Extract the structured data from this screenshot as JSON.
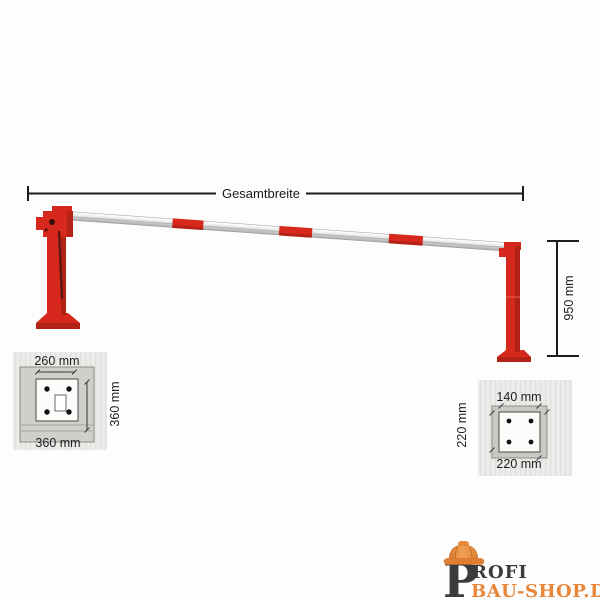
{
  "dimensions": {
    "total_width": "Gesamtbreite",
    "post_height": "950 mm"
  },
  "left_base_plate": {
    "top_width": "260 mm",
    "bottom_width": "360 mm",
    "side_height": "360 mm"
  },
  "right_base_plate": {
    "top_width": "140 mm",
    "bottom_width": "220 mm",
    "side_height": "220 mm"
  },
  "logo": {
    "initial": "P",
    "name_rest": "ROFI",
    "second_line": "BAU-SHOP.DE"
  },
  "colors": {
    "barrier_red": "#d6281c",
    "barrier_red_dark": "#a92015",
    "dimension_line": "#1c1c1c",
    "panel_gray": "#eaeae8",
    "plate_gray": "#cdcdc9",
    "logo_dark": "#3b3b3d",
    "logo_orange": "#e8873a"
  }
}
